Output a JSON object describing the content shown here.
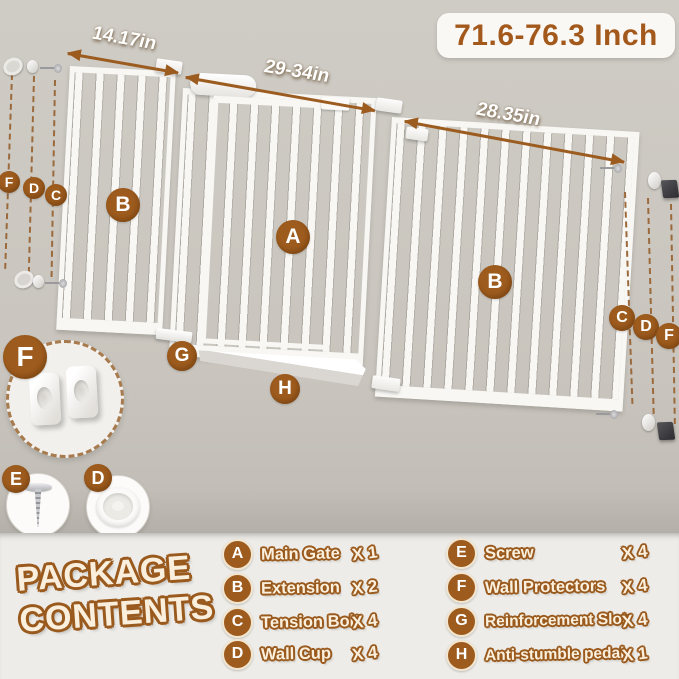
{
  "header": {
    "size_range": "71.6-76.3 Inch"
  },
  "dimensions": {
    "left_extension": "14.17in",
    "main_gate": "29-34in",
    "right_extension": "28.35in"
  },
  "package": {
    "title_line1": "PACKAGE",
    "title_line2": "CONTENTS",
    "items": [
      {
        "key": "A",
        "name": "Main Gate",
        "qty": "X 1"
      },
      {
        "key": "B",
        "name": "Extension",
        "qty": "X 2"
      },
      {
        "key": "C",
        "name": "Tension Bolt",
        "qty": "X 4"
      },
      {
        "key": "D",
        "name": "Wall Cup",
        "qty": "X 4"
      },
      {
        "key": "E",
        "name": "Screw",
        "qty": "X 4"
      },
      {
        "key": "F",
        "name": "Wall Protectors",
        "qty": "X 4"
      },
      {
        "key": "G",
        "name": "Reinforcement Slot",
        "qty": "X 4"
      },
      {
        "key": "H",
        "name": "Anti-stumble pedal",
        "qty": "X 1"
      }
    ]
  },
  "colors": {
    "accent_brown": "#9b5a1e",
    "title_text": "#a3591c",
    "cream_text": "#f9efdc",
    "background_top": "#cbc7c0",
    "background_bottom": "#edece8",
    "gate_white": "#f8f7f4",
    "wall_protector_dark": "#3a393b"
  }
}
